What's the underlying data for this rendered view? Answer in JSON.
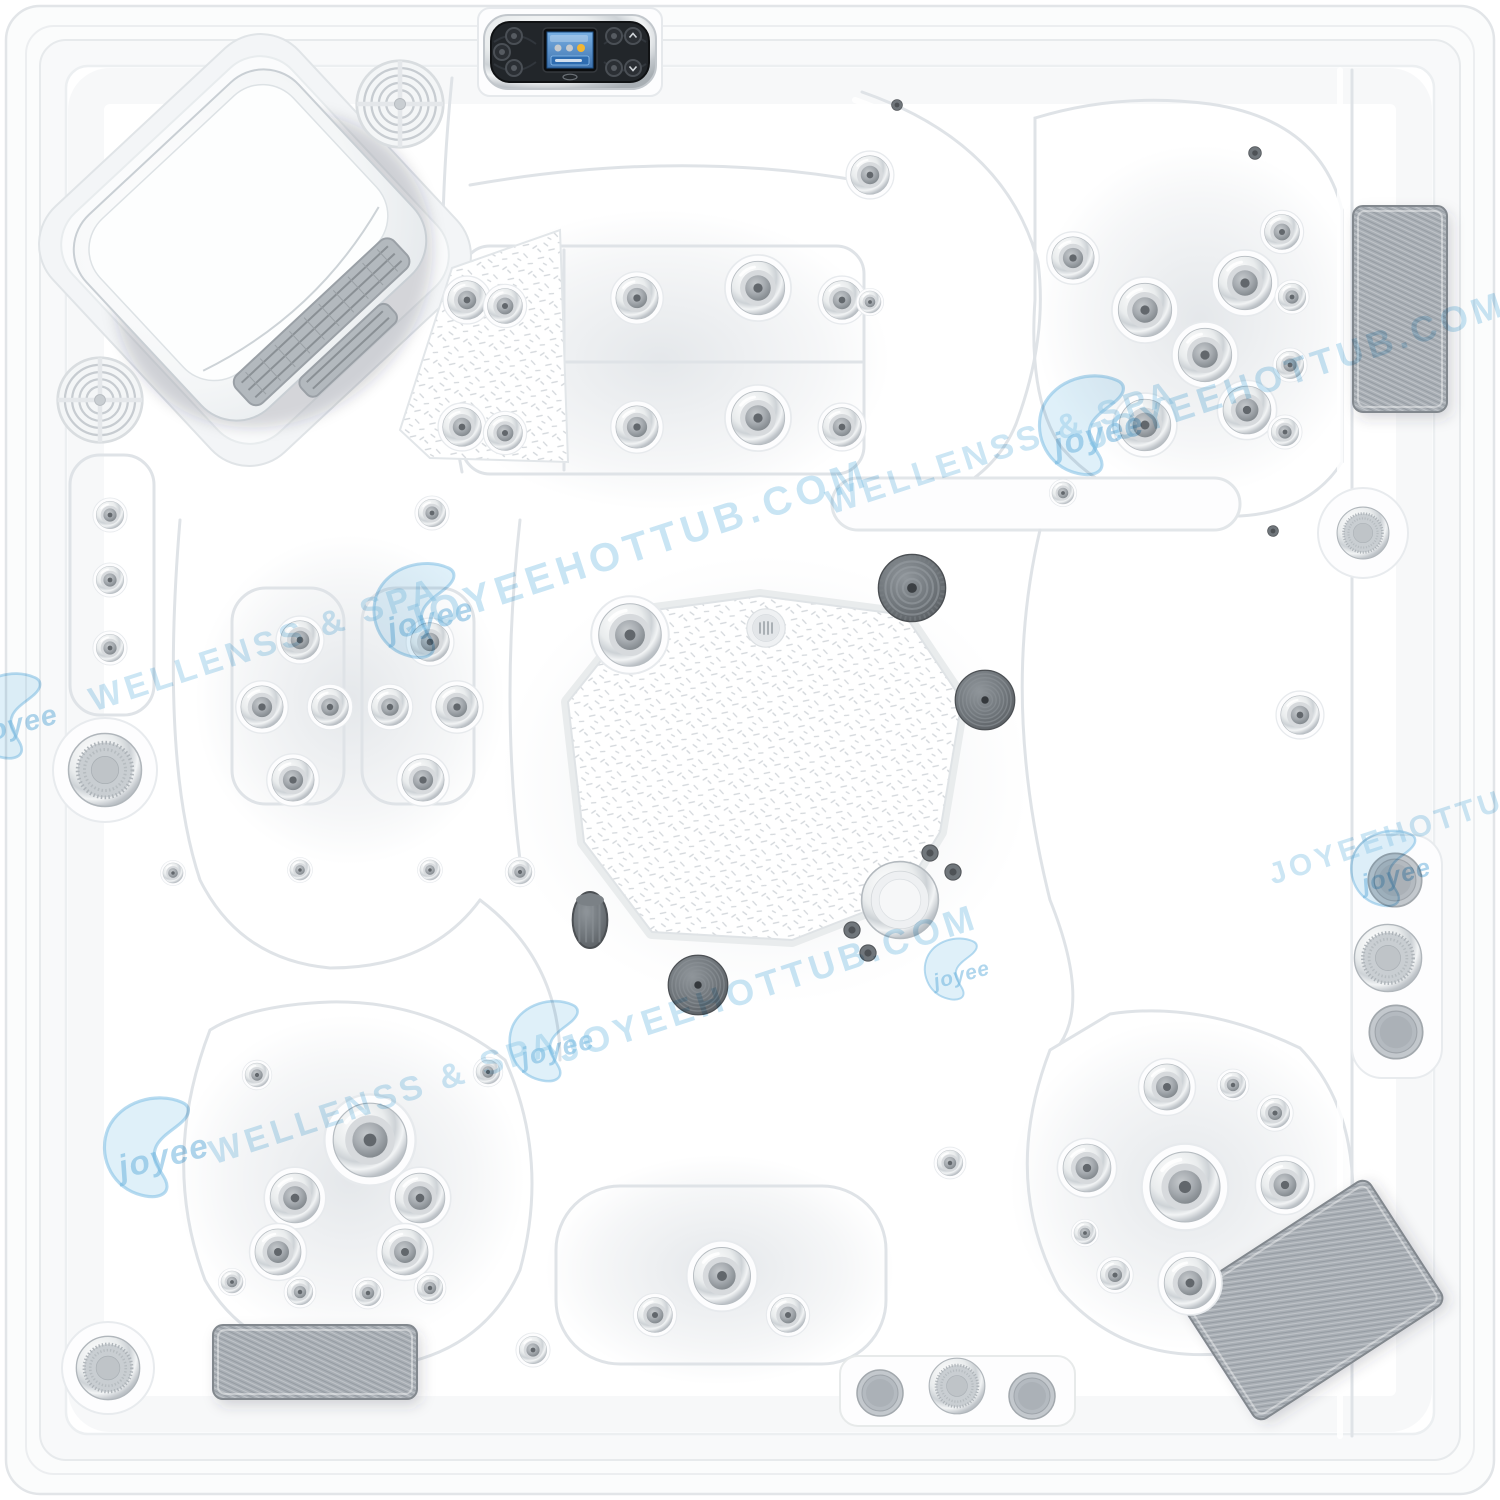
{
  "product": {
    "description_label": "hot-tub-top-view",
    "colors": {
      "shell": "#ffffff",
      "shell_shadow": "#e7eaed",
      "watermark_blue": "#7fc0e4",
      "pad_gray": "#a9afb5",
      "jet_chrome": "#cdd2d6",
      "jet_dark": "#6f757a",
      "panel_body": "#22262a",
      "panel_screen": "#4f8fd0",
      "panel_accent": "#f2b632"
    }
  },
  "watermarks": [
    {
      "kind": "logo",
      "text": "joyee",
      "x": 425,
      "y": 615,
      "s": 1.0
    },
    {
      "kind": "text",
      "text": "JOYEEHOTTUB.COM",
      "x": 640,
      "y": 560,
      "rot": -18,
      "size": 40,
      "op": 0.42
    },
    {
      "kind": "text",
      "text": "WELLENSS & SPA",
      "x": 268,
      "y": 655,
      "rot": -18,
      "size": 34,
      "op": 0.4
    },
    {
      "kind": "text",
      "text": "WELLENSS & SPA",
      "x": 1005,
      "y": 458,
      "rot": -18,
      "size": 34,
      "op": 0.4
    },
    {
      "kind": "logo",
      "text": "joyee",
      "x": 1093,
      "y": 430,
      "s": 1.05
    },
    {
      "kind": "text",
      "text": "JOYEEHOTTUB.COM",
      "x": 1300,
      "y": 382,
      "rot": -18,
      "size": 36,
      "op": 0.42
    },
    {
      "kind": "logo",
      "text": "joyee",
      "x": 553,
      "y": 1045,
      "s": 0.85
    },
    {
      "kind": "text",
      "text": "JOYEEHOTTUB.COM",
      "x": 772,
      "y": 995,
      "rot": -18,
      "size": 36,
      "op": 0.42
    },
    {
      "kind": "logo",
      "text": "joyee",
      "x": 158,
      "y": 1152,
      "s": 1.05
    },
    {
      "kind": "text",
      "text": "WELLENSS & SPA",
      "x": 388,
      "y": 1108,
      "rot": -18,
      "size": 34,
      "op": 0.4
    },
    {
      "kind": "text",
      "text": "JOYEEHOTTUB.COM",
      "x": 1447,
      "y": 828,
      "rot": -18,
      "size": 30,
      "op": 0.4
    },
    {
      "kind": "logo",
      "text": "joyee",
      "x": 1392,
      "y": 872,
      "s": 0.8
    },
    {
      "kind": "logo",
      "text": "joyee",
      "x": 958,
      "y": 972,
      "s": 0.65
    },
    {
      "kind": "logo",
      "text": "joyee",
      "x": 14,
      "y": 720,
      "s": 0.9
    }
  ],
  "fixtures": [
    [
      "speaker",
      400,
      104,
      46
    ],
    [
      "speaker",
      100,
      400,
      45
    ],
    [
      "jet",
      467,
      300,
      21
    ],
    [
      "jet",
      505,
      306,
      19
    ],
    [
      "jet",
      637,
      298,
      23
    ],
    [
      "jet",
      758,
      288,
      29
    ],
    [
      "jet",
      842,
      300,
      21
    ],
    [
      "jet",
      462,
      427,
      21
    ],
    [
      "jet",
      505,
      433,
      19
    ],
    [
      "jet",
      637,
      427,
      23
    ],
    [
      "jet",
      758,
      418,
      29
    ],
    [
      "jet",
      842,
      427,
      21
    ],
    [
      "jet",
      870,
      175,
      21
    ],
    [
      "jet",
      1073,
      258,
      23
    ],
    [
      "jet",
      870,
      302,
      12
    ],
    [
      "jet",
      432,
      513,
      15
    ],
    [
      "screw",
      897,
      105,
      6
    ],
    [
      "screw",
      1255,
      153,
      7
    ],
    [
      "screw",
      1273,
      531,
      6
    ],
    [
      "jet",
      1282,
      232,
      19
    ],
    [
      "jet",
      1245,
      283,
      29
    ],
    [
      "jet",
      1145,
      310,
      29
    ],
    [
      "jet",
      1292,
      297,
      15
    ],
    [
      "jet",
      1205,
      355,
      29
    ],
    [
      "jet",
      1290,
      365,
      15
    ],
    [
      "jet",
      1247,
      410,
      26
    ],
    [
      "jet",
      1145,
      425,
      28
    ],
    [
      "jet",
      1285,
      432,
      15
    ],
    [
      "jet",
      1063,
      493,
      12
    ],
    [
      "jet",
      1300,
      715,
      21
    ],
    [
      "knob",
      1363,
      533,
      27
    ],
    [
      "graycap",
      1395,
      880,
      29
    ],
    [
      "knob",
      1388,
      958,
      35
    ],
    [
      "graycap",
      1396,
      1032,
      29
    ],
    [
      "jet",
      630,
      635,
      34
    ],
    [
      "draincap",
      766,
      628,
      20
    ],
    [
      "darkdome",
      912,
      588,
      35
    ],
    [
      "darkcoil",
      985,
      700,
      31
    ],
    [
      "cylinder",
      590,
      920,
      28
    ],
    [
      "darkcoil",
      698,
      985,
      31
    ],
    [
      "chromedrain",
      900,
      900,
      40
    ],
    [
      "screw",
      930,
      853,
      9
    ],
    [
      "screw",
      953,
      872,
      9
    ],
    [
      "screw",
      852,
      930,
      9
    ],
    [
      "screw",
      868,
      953,
      9
    ],
    [
      "jet",
      950,
      1163,
      14
    ],
    [
      "jet",
      110,
      515,
      15
    ],
    [
      "jet",
      110,
      580,
      15
    ],
    [
      "jet",
      110,
      648,
      15
    ],
    [
      "knob",
      105,
      770,
      38
    ],
    [
      "jet",
      300,
      640,
      21
    ],
    [
      "jet",
      430,
      642,
      21
    ],
    [
      "jet",
      262,
      707,
      23
    ],
    [
      "jet",
      330,
      707,
      20
    ],
    [
      "jet",
      390,
      707,
      20
    ],
    [
      "jet",
      457,
      707,
      23
    ],
    [
      "jet",
      293,
      780,
      23
    ],
    [
      "jet",
      423,
      780,
      23
    ],
    [
      "jet",
      173,
      873,
      11
    ],
    [
      "jet",
      300,
      870,
      11
    ],
    [
      "jet",
      430,
      870,
      11
    ],
    [
      "jet",
      520,
      872,
      13
    ],
    [
      "jet",
      257,
      1075,
      13
    ],
    [
      "jet",
      488,
      1072,
      13
    ],
    [
      "jet",
      370,
      1140,
      40
    ],
    [
      "jet",
      295,
      1198,
      27
    ],
    [
      "jet",
      420,
      1198,
      27
    ],
    [
      "jet",
      278,
      1252,
      25
    ],
    [
      "jet",
      405,
      1252,
      25
    ],
    [
      "jet",
      232,
      1282,
      12
    ],
    [
      "jet",
      300,
      1292,
      14
    ],
    [
      "jet",
      368,
      1293,
      14
    ],
    [
      "jet",
      430,
      1288,
      14
    ],
    [
      "knob",
      108,
      1368,
      33
    ],
    [
      "jet",
      533,
      1350,
      15
    ],
    [
      "jet",
      722,
      1276,
      31
    ],
    [
      "jet",
      655,
      1315,
      19
    ],
    [
      "jet",
      788,
      1315,
      19
    ],
    [
      "graycap",
      880,
      1393,
      25
    ],
    [
      "knob",
      957,
      1386,
      29
    ],
    [
      "graycap",
      1032,
      1396,
      25
    ],
    [
      "jet",
      1167,
      1087,
      25
    ],
    [
      "jet",
      1233,
      1085,
      14
    ],
    [
      "jet",
      1275,
      1113,
      16
    ],
    [
      "jet",
      1087,
      1168,
      26
    ],
    [
      "jet",
      1185,
      1187,
      38
    ],
    [
      "jet",
      1285,
      1185,
      26
    ],
    [
      "jet",
      1085,
      1233,
      12
    ],
    [
      "jet",
      1115,
      1275,
      16
    ],
    [
      "jet",
      1190,
      1283,
      28
    ]
  ],
  "pads": [
    {
      "cx": 1400,
      "cy": 309,
      "w": 94,
      "h": 206,
      "rot": 0
    },
    {
      "cx": 315,
      "cy": 1362,
      "w": 204,
      "h": 74,
      "rot": 0
    },
    {
      "cx": 1312,
      "cy": 1300,
      "w": 224,
      "h": 148,
      "rot": -33
    }
  ],
  "panel": {
    "left_buttons": [
      "power-button",
      "mode-button",
      "light-button"
    ],
    "right_buttons": [
      "jets1-button",
      "temp-up-button",
      "jets2-button",
      "temp-down-button"
    ],
    "screen_dots": [
      "#c6cacd",
      "#c6cacd",
      "#f2b632"
    ]
  }
}
